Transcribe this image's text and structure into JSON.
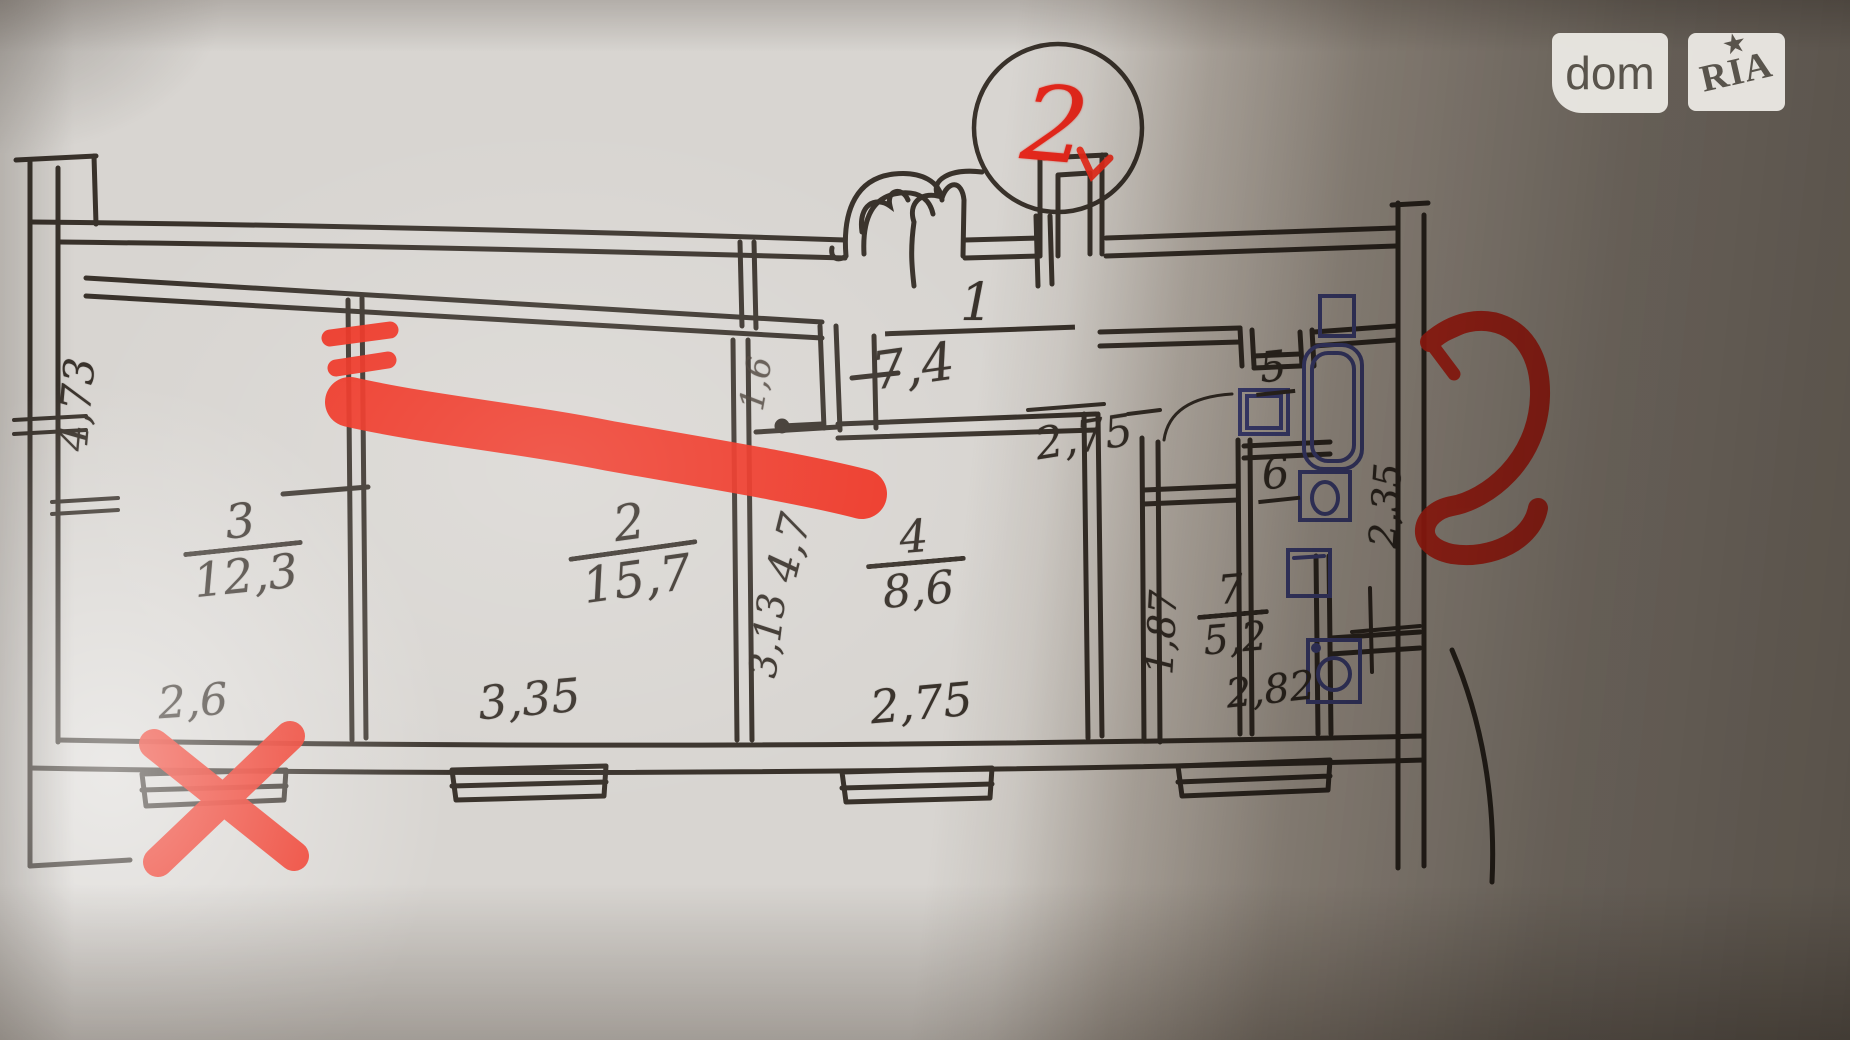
{
  "watermark": {
    "brand_left": "dom",
    "brand_right": "RIA",
    "star": "★"
  },
  "red_annotations": {
    "circled_number": "2"
  },
  "colors": {
    "ink": "#39322b",
    "red_marker": "#ee2b1a",
    "blue_pen": "#4a4f99",
    "paper": "#d8d5d1"
  },
  "rooms": {
    "r1": {
      "number": "1",
      "area": "7,4"
    },
    "r2": {
      "number": "2",
      "area": "15,7"
    },
    "r3": {
      "number": "3",
      "area": "12,3"
    },
    "r4": {
      "number": "4",
      "area": "8,6"
    },
    "r5": {
      "number": "5"
    },
    "r6": {
      "number": "6"
    },
    "r7": {
      "number": "7",
      "area": "5,2"
    }
  },
  "dimensions": {
    "left_wall_height": "4,73",
    "corridor_width": "1,6",
    "hall_depth": "4,7",
    "room4_depth": "3,13",
    "room1_width": "2,75",
    "bath_width": "2,35",
    "bath_depth": "1,87",
    "toilet_width": "2,82",
    "room3_width": "2,6",
    "room2_width": "3,35",
    "room4_width": "2,75"
  }
}
